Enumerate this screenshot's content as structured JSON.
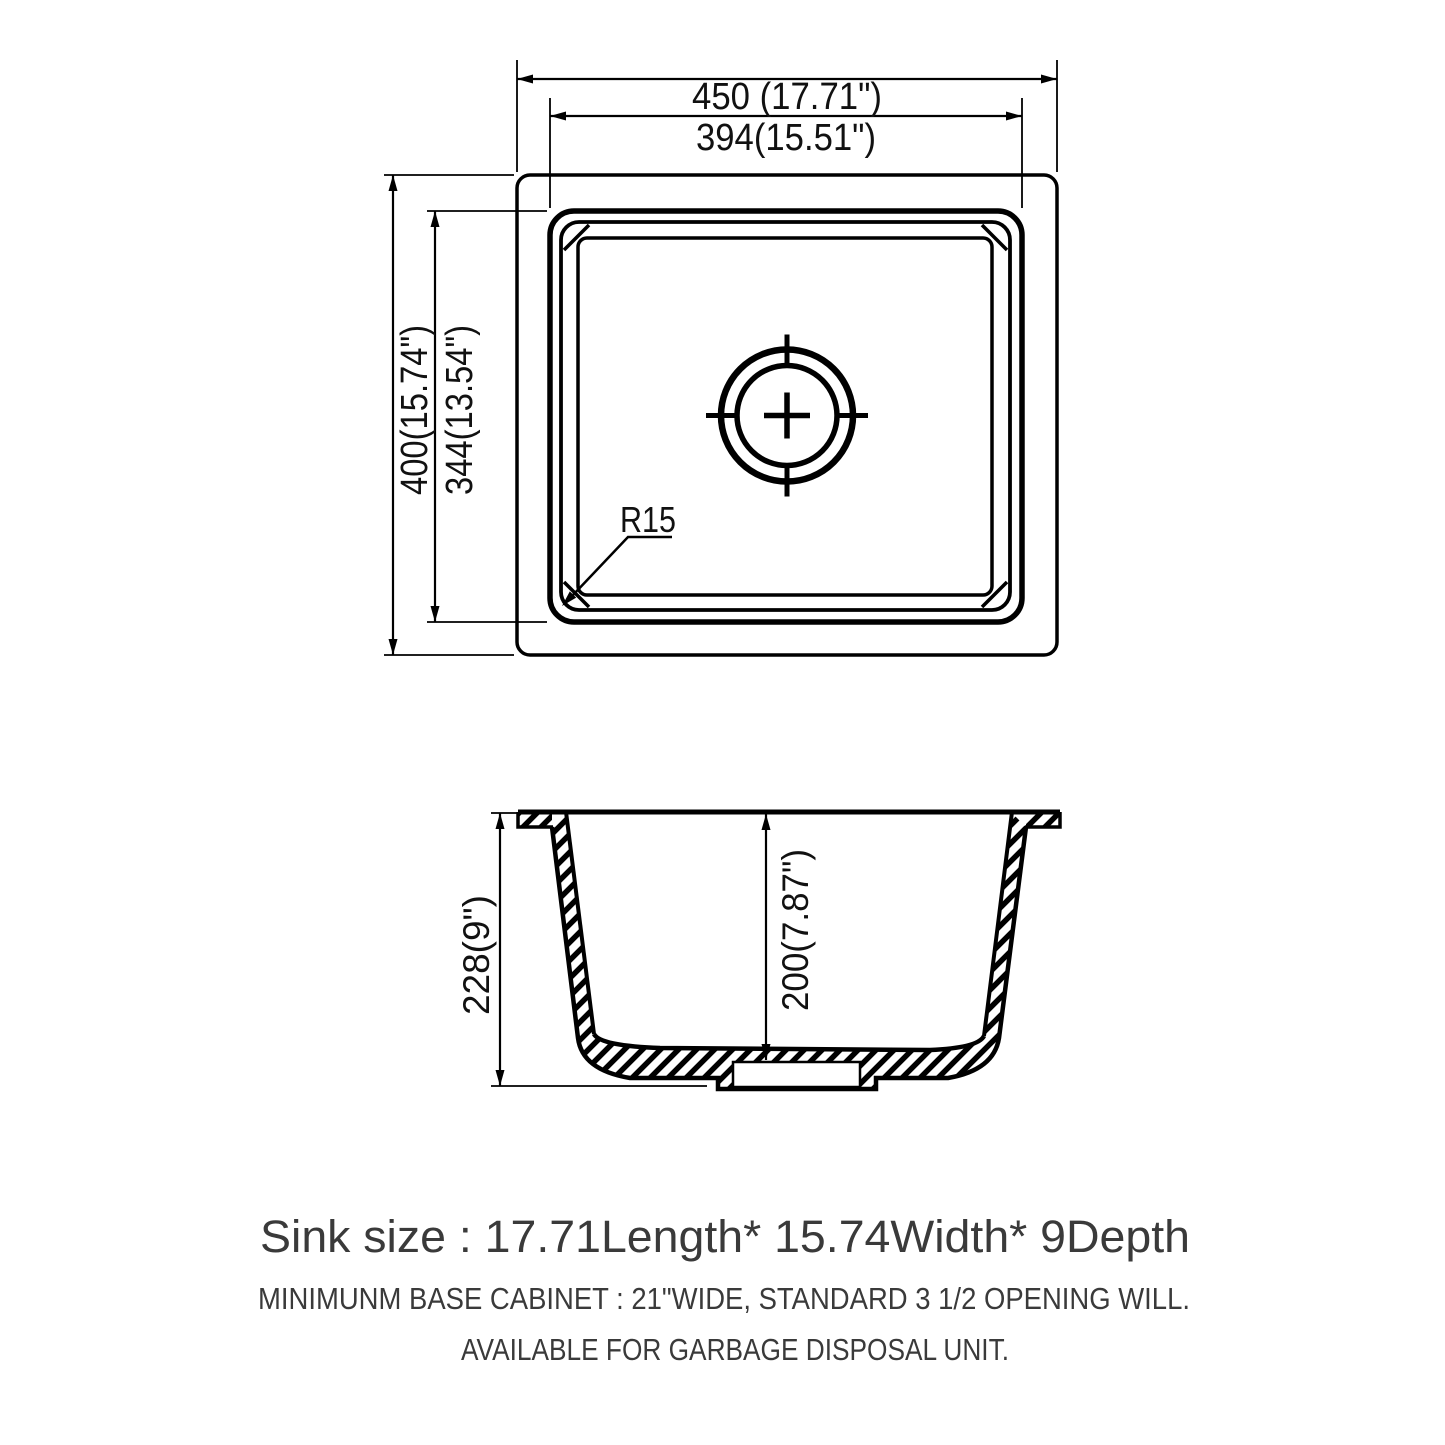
{
  "drawing": {
    "title_meaning": "sink technical drawing",
    "top_view": {
      "dim_width_outer": "450 (17.71\")",
      "dim_width_inner": "394(15.51\")",
      "dim_height_outer": "400(15.74\")",
      "dim_height_inner": "344(13.54\")",
      "corner_radius_label": "R15"
    },
    "section_view": {
      "dim_depth_outer": "228(9\")",
      "dim_depth_inner": "200(7.87\")"
    },
    "footer": {
      "size_line": "Sink size :  17.71Length* 15.74Width* 9Depth",
      "note_line1": "MINIMUNM BASE CABINET : 21\"WIDE,  STANDARD 3 1/2 OPENING WILL.",
      "note_line2": "AVAILABLE FOR GARBAGE DISPOSAL UNIT."
    },
    "colors": {
      "line": "#000000",
      "dim_text": "#111111",
      "footer_text": "#3a3a3a",
      "background": "#ffffff"
    }
  }
}
